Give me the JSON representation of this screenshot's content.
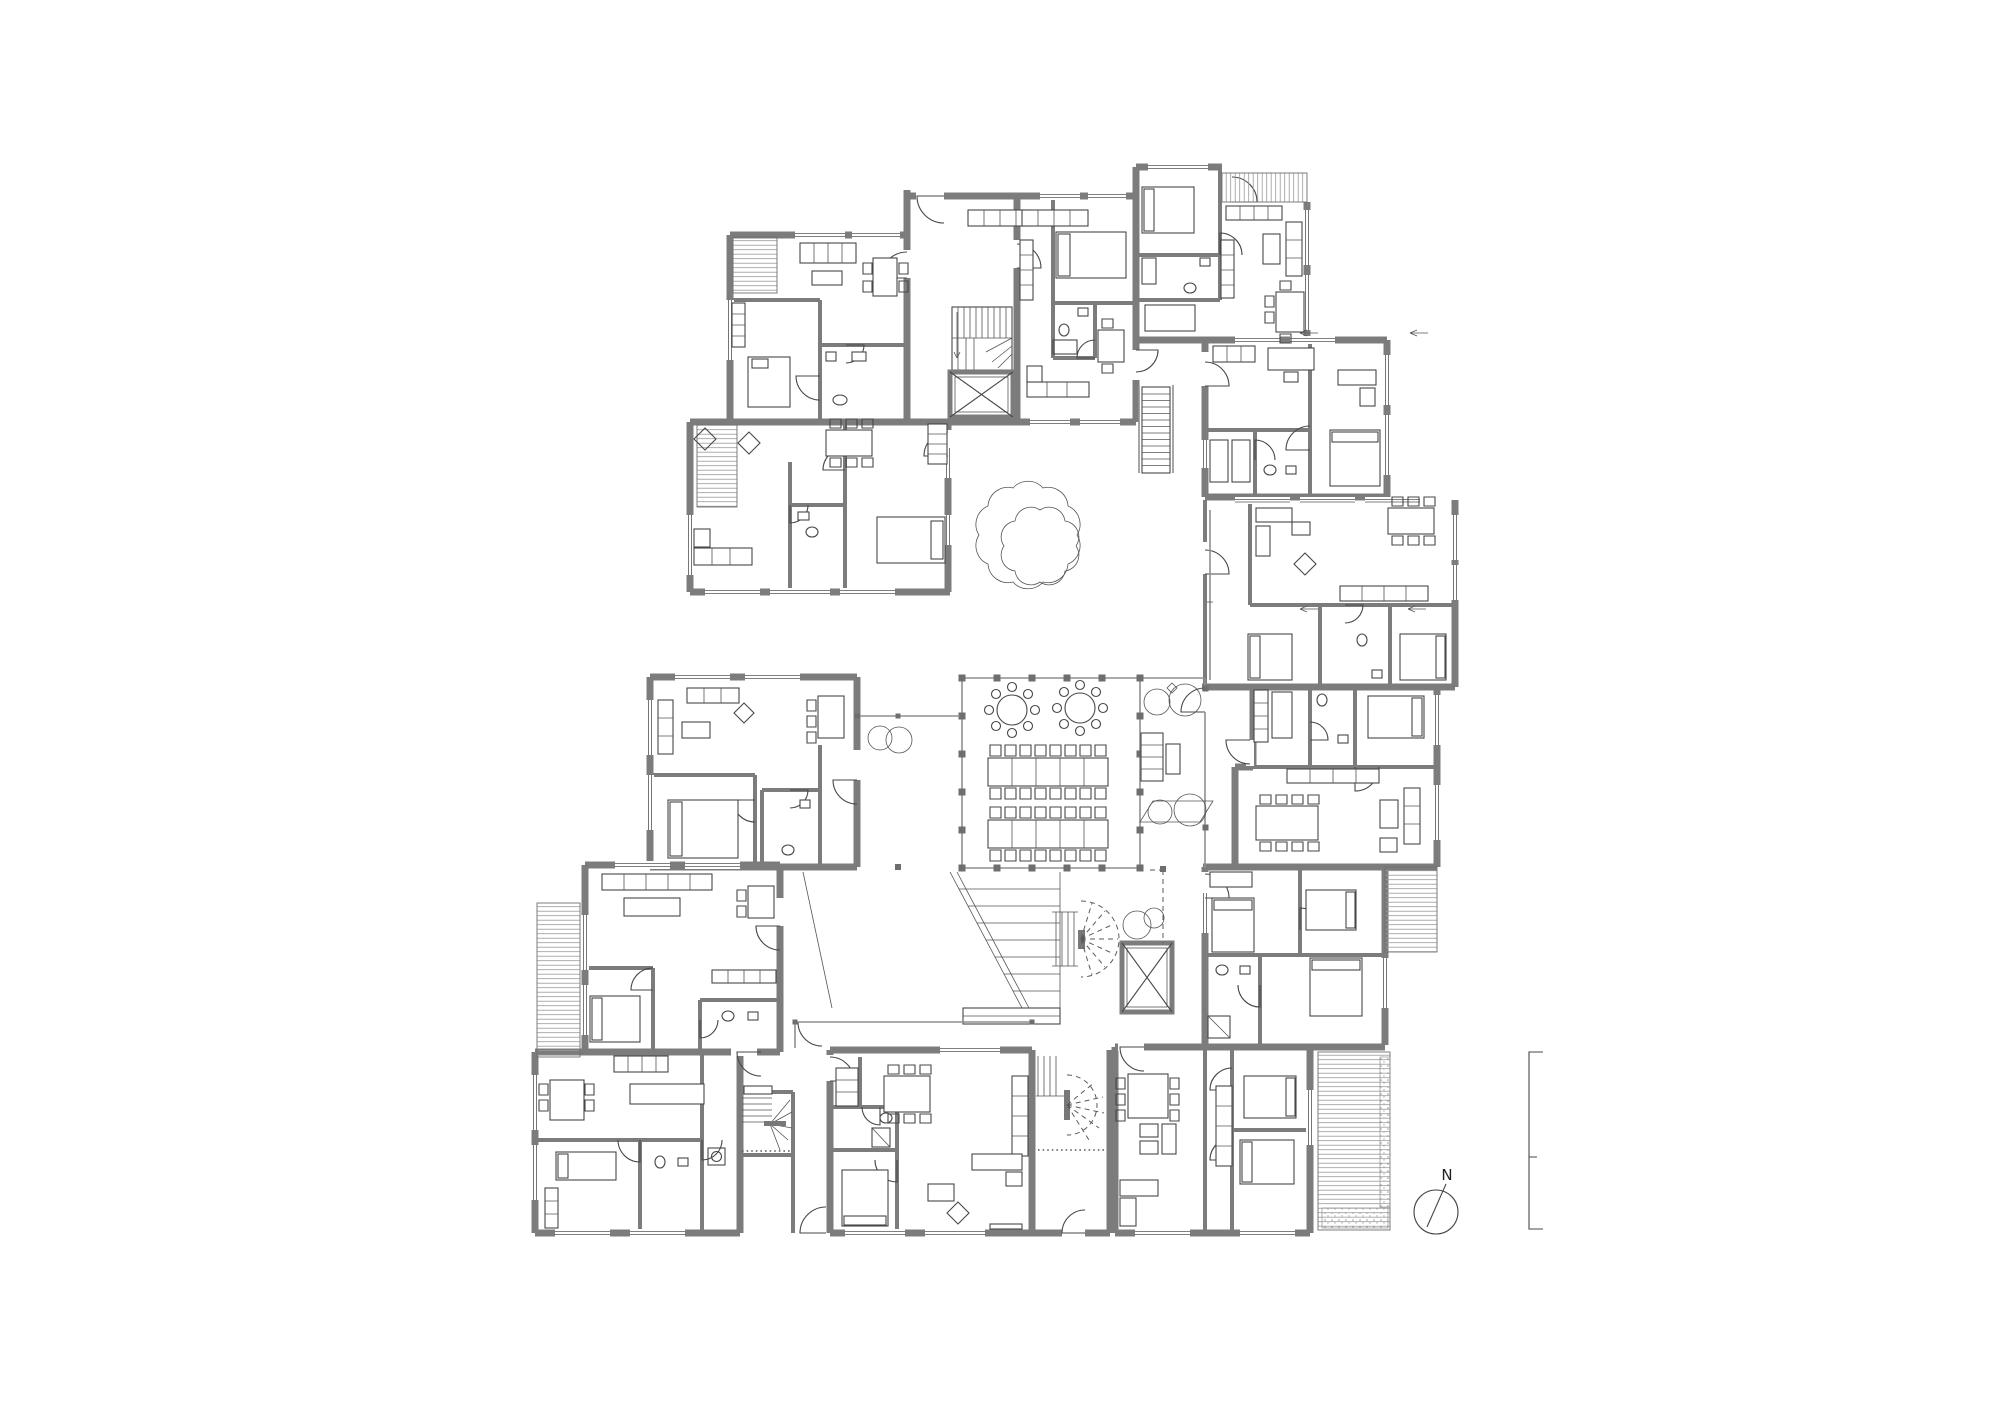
{
  "canvas": {
    "width": 2000,
    "height": 1414,
    "background": "#ffffff"
  },
  "drawing": {
    "type": "architectural floor plan",
    "colors": {
      "structural_walls": "#7c7c7c",
      "linework": "#474747",
      "background": "#ffffff"
    }
  },
  "compass": {
    "label": "N"
  },
  "communal_hall": {
    "round_tables": 2,
    "chairs_per_round_table": 8,
    "long_table_rows": 2,
    "chairs_per_long_row": 16
  },
  "circulation": {
    "elevators": 2,
    "staircases": 5,
    "amphitheater_steps": 8
  },
  "landscape": {
    "large_courtyard_trees": 1,
    "shrub_groups": 4,
    "paired_trees": 1
  }
}
